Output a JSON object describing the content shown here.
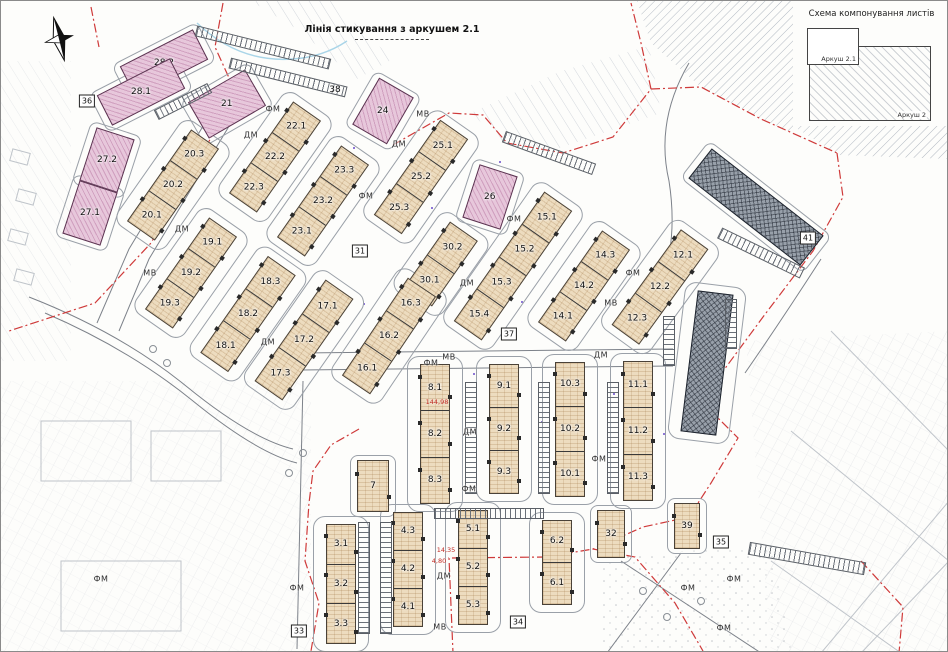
{
  "top_note": {
    "text": "Лінія стикування з аркушем 2.1"
  },
  "legend": {
    "title": "Схема компонування листів",
    "sheet_small": "Аркуш 2.1",
    "sheet_large": "Аркуш 2"
  },
  "colors": {
    "tan_building": "#eddcbf",
    "pink_building": "#e7c7db",
    "dark_building": "#98a0aa",
    "boundary_red": "#cf3a3a",
    "outline_gray": "#9aa0a8",
    "annotation_purple": "#7a5fd0"
  },
  "map": {
    "strips": [
      {
        "id": "20",
        "type": "tan",
        "cx": 172,
        "cy": 184,
        "w": 34,
        "h": 112,
        "a": 35,
        "labels": [
          "20.3",
          "20.2",
          "20.1"
        ]
      },
      {
        "id": "22",
        "type": "tan",
        "cx": 274,
        "cy": 156,
        "w": 34,
        "h": 112,
        "a": 35,
        "labels": [
          "22.1",
          "22.2",
          "22.3"
        ]
      },
      {
        "id": "23",
        "type": "tan",
        "cx": 322,
        "cy": 200,
        "w": 34,
        "h": 112,
        "a": 35,
        "labels": [
          "23.3",
          "23.2",
          "23.1"
        ]
      },
      {
        "id": "25",
        "type": "tan",
        "cx": 420,
        "cy": 176,
        "w": 34,
        "h": 116,
        "a": 35,
        "labels": [
          "25.1",
          "25.2",
          "25.3"
        ]
      },
      {
        "id": "30",
        "type": "tan",
        "cx": 440,
        "cy": 263,
        "w": 34,
        "h": 80,
        "a": 35,
        "labels": [
          "30.2",
          "30.1"
        ]
      },
      {
        "id": "15",
        "type": "tan",
        "cx": 512,
        "cy": 265,
        "w": 34,
        "h": 158,
        "a": 35,
        "labels": [
          "15.1",
          "15.2",
          "15.3",
          "15.4"
        ]
      },
      {
        "id": "14",
        "type": "tan",
        "cx": 583,
        "cy": 285,
        "w": 34,
        "h": 112,
        "a": 35,
        "labels": [
          "14.3",
          "14.2",
          "14.1"
        ]
      },
      {
        "id": "12",
        "type": "tan",
        "cx": 659,
        "cy": 286,
        "w": 34,
        "h": 118,
        "a": 36,
        "labels": [
          "12.1",
          "12.2",
          "12.3"
        ]
      },
      {
        "id": "19",
        "type": "tan",
        "cx": 190,
        "cy": 272,
        "w": 34,
        "h": 112,
        "a": 35,
        "labels": [
          "19.1",
          "19.2",
          "19.3"
        ]
      },
      {
        "id": "18",
        "type": "tan",
        "cx": 247,
        "cy": 313,
        "w": 34,
        "h": 118,
        "a": 35,
        "labels": [
          "18.3",
          "18.2",
          "18.1"
        ]
      },
      {
        "id": "17",
        "type": "tan",
        "cx": 303,
        "cy": 339,
        "w": 34,
        "h": 124,
        "a": 35,
        "labels": [
          "17.1",
          "17.2",
          "17.3"
        ]
      },
      {
        "id": "16",
        "type": "tan",
        "cx": 388,
        "cy": 335,
        "w": 34,
        "h": 118,
        "a": 34,
        "labels": [
          "16.3",
          "16.2",
          "16.1"
        ]
      },
      {
        "id": "8",
        "type": "tan",
        "cx": 434,
        "cy": 433,
        "w": 30,
        "h": 140,
        "a": 0,
        "labels": [
          "8.1",
          "8.2",
          "8.3"
        ]
      },
      {
        "id": "9",
        "type": "tan",
        "cx": 503,
        "cy": 428,
        "w": 30,
        "h": 130,
        "a": 0,
        "labels": [
          "9.1",
          "9.2",
          "9.3"
        ]
      },
      {
        "id": "10",
        "type": "tan",
        "cx": 569,
        "cy": 428,
        "w": 30,
        "h": 135,
        "a": 0,
        "labels": [
          "10.3",
          "10.2",
          "10.1"
        ]
      },
      {
        "id": "11",
        "type": "tan",
        "cx": 637,
        "cy": 430,
        "w": 30,
        "h": 140,
        "a": 0,
        "labels": [
          "11.1",
          "11.2",
          "11.3"
        ]
      },
      {
        "id": "3",
        "type": "tan",
        "cx": 340,
        "cy": 583,
        "w": 30,
        "h": 120,
        "a": 0,
        "labels": [
          "3.1",
          "3.2",
          "3.3"
        ]
      },
      {
        "id": "4",
        "type": "tan",
        "cx": 407,
        "cy": 568,
        "w": 30,
        "h": 115,
        "a": 0,
        "labels": [
          "4.3",
          "4.2",
          "4.1"
        ]
      },
      {
        "id": "5",
        "type": "tan",
        "cx": 472,
        "cy": 566,
        "w": 30,
        "h": 115,
        "a": 0,
        "labels": [
          "5.1",
          "5.2",
          "5.3"
        ]
      },
      {
        "id": "6",
        "type": "tan",
        "cx": 556,
        "cy": 561,
        "w": 30,
        "h": 85,
        "a": 0,
        "labels": [
          "6.2",
          "6.1"
        ]
      },
      {
        "id": "7",
        "type": "tan",
        "cx": 372,
        "cy": 485,
        "w": 32,
        "h": 52,
        "a": 0,
        "labels": [
          "7"
        ]
      },
      {
        "id": "32",
        "type": "tan",
        "cx": 610,
        "cy": 533,
        "w": 28,
        "h": 48,
        "a": 0,
        "labels": [
          "32"
        ]
      },
      {
        "id": "39",
        "type": "tan",
        "cx": 686,
        "cy": 525,
        "w": 26,
        "h": 46,
        "a": 0,
        "labels": [
          "39"
        ]
      },
      {
        "id": "28.2",
        "type": "pink",
        "cx": 163,
        "cy": 62,
        "w": 82,
        "h": 34,
        "a": -27,
        "labels": [
          "28.2"
        ]
      },
      {
        "id": "28.1",
        "type": "pink",
        "cx": 140,
        "cy": 91,
        "w": 82,
        "h": 34,
        "a": -27,
        "labels": [
          "28.1"
        ]
      },
      {
        "id": "27.2",
        "type": "pink",
        "cx": 106,
        "cy": 159,
        "w": 40,
        "h": 56,
        "a": 18,
        "labels": [
          "27.2"
        ]
      },
      {
        "id": "27.1",
        "type": "pink",
        "cx": 89,
        "cy": 212,
        "w": 40,
        "h": 56,
        "a": 18,
        "labels": [
          "27.1"
        ]
      },
      {
        "id": "21",
        "type": "pink",
        "cx": 226,
        "cy": 103,
        "w": 66,
        "h": 42,
        "a": -30,
        "labels": [
          "21"
        ]
      },
      {
        "id": "24",
        "type": "pink",
        "cx": 382,
        "cy": 110,
        "w": 40,
        "h": 54,
        "a": 30,
        "labels": [
          "24"
        ]
      },
      {
        "id": "26",
        "type": "pink",
        "cx": 489,
        "cy": 196,
        "w": 40,
        "h": 56,
        "a": 18,
        "labels": [
          "26"
        ]
      },
      {
        "id": "41",
        "type": "dark",
        "cx": 755,
        "cy": 206,
        "w": 142,
        "h": 38,
        "a": 38,
        "labels": []
      },
      {
        "id": "40",
        "type": "dark",
        "cx": 706,
        "cy": 362,
        "w": 36,
        "h": 142,
        "a": 7,
        "labels": []
      }
    ],
    "parking_rows": [
      {
        "cx": 262,
        "cy": 46,
        "w": 138,
        "h": 11,
        "a": 14
      },
      {
        "cx": 287,
        "cy": 76,
        "w": 120,
        "h": 11,
        "a": 14
      },
      {
        "cx": 182,
        "cy": 100,
        "w": 60,
        "h": 11,
        "a": -27
      },
      {
        "cx": 548,
        "cy": 152,
        "w": 96,
        "h": 12,
        "a": 20
      },
      {
        "cx": 760,
        "cy": 252,
        "w": 92,
        "h": 12,
        "a": 26
      },
      {
        "cx": 806,
        "cy": 557,
        "w": 118,
        "h": 13,
        "a": 10
      },
      {
        "cx": 363,
        "cy": 577,
        "w": 12,
        "h": 112,
        "a": 0
      },
      {
        "cx": 385,
        "cy": 577,
        "w": 12,
        "h": 112,
        "a": 0
      },
      {
        "cx": 470,
        "cy": 437,
        "w": 12,
        "h": 112,
        "a": 0
      },
      {
        "cx": 543,
        "cy": 437,
        "w": 12,
        "h": 112,
        "a": 0
      },
      {
        "cx": 612,
        "cy": 437,
        "w": 12,
        "h": 112,
        "a": 0
      },
      {
        "cx": 668,
        "cy": 340,
        "w": 12,
        "h": 50,
        "a": 0
      },
      {
        "cx": 730,
        "cy": 323,
        "w": 12,
        "h": 50,
        "a": 0
      },
      {
        "cx": 488,
        "cy": 512,
        "w": 110,
        "h": 11,
        "a": 0
      }
    ],
    "zone_labels": [
      {
        "t": "ДМ",
        "x": 250,
        "y": 134
      },
      {
        "t": "ДМ",
        "x": 181,
        "y": 228
      },
      {
        "t": "ДМ",
        "x": 398,
        "y": 143
      },
      {
        "t": "ДМ",
        "x": 466,
        "y": 282
      },
      {
        "t": "ДМ",
        "x": 267,
        "y": 341
      },
      {
        "t": "ДМ",
        "x": 600,
        "y": 354
      },
      {
        "t": "ДМ",
        "x": 469,
        "y": 431
      },
      {
        "t": "ДМ",
        "x": 443,
        "y": 575
      },
      {
        "t": "МВ",
        "x": 149,
        "y": 272
      },
      {
        "t": "МВ",
        "x": 422,
        "y": 113
      },
      {
        "t": "МВ",
        "x": 448,
        "y": 356
      },
      {
        "t": "МВ",
        "x": 610,
        "y": 302
      },
      {
        "t": "МВ",
        "x": 439,
        "y": 626
      },
      {
        "t": "ФМ",
        "x": 272,
        "y": 108
      },
      {
        "t": "ФМ",
        "x": 365,
        "y": 195
      },
      {
        "t": "ФМ",
        "x": 513,
        "y": 218
      },
      {
        "t": "ФМ",
        "x": 632,
        "y": 272
      },
      {
        "t": "ФМ",
        "x": 430,
        "y": 362
      },
      {
        "t": "ФМ",
        "x": 468,
        "y": 488
      },
      {
        "t": "ФМ",
        "x": 598,
        "y": 458
      },
      {
        "t": "ФМ",
        "x": 296,
        "y": 587
      },
      {
        "t": "ФМ",
        "x": 100,
        "y": 578
      },
      {
        "t": "ФМ",
        "x": 687,
        "y": 587
      },
      {
        "t": "ФМ",
        "x": 733,
        "y": 578
      },
      {
        "t": "ФМ",
        "x": 723,
        "y": 627
      }
    ],
    "boxed_numbers": [
      {
        "t": "36",
        "x": 86,
        "y": 100
      },
      {
        "t": "31",
        "x": 359,
        "y": 250
      },
      {
        "t": "37",
        "x": 508,
        "y": 333
      },
      {
        "t": "33",
        "x": 298,
        "y": 630
      },
      {
        "t": "34",
        "x": 517,
        "y": 621
      },
      {
        "t": "35",
        "x": 720,
        "y": 541
      },
      {
        "t": "41",
        "x": 807,
        "y": 237
      }
    ],
    "plain_numbers": [
      {
        "t": "38",
        "x": 334,
        "y": 89
      }
    ],
    "dimensions": [
      {
        "t": "144,98",
        "x": 436,
        "y": 401
      },
      {
        "t": "14,35",
        "x": 445,
        "y": 549
      },
      {
        "t": "4,80",
        "x": 438,
        "y": 560
      }
    ]
  }
}
